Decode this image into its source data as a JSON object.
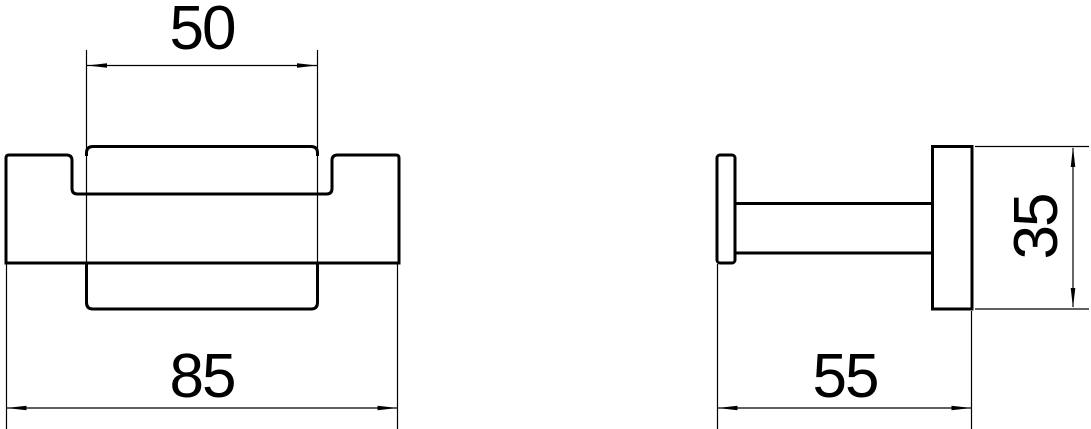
{
  "page": {
    "background_color": "#ffffff",
    "line_color": "#000000"
  },
  "drawing": {
    "type": "technical-dimension-drawing",
    "subject": "wall-hook-two-view-drawing",
    "views": [
      {
        "name": "front-view",
        "dimensions": [
          {
            "id": "plate-width",
            "label": "50",
            "orientation": "horizontal"
          },
          {
            "id": "overall-width",
            "label": "85",
            "orientation": "horizontal"
          }
        ]
      },
      {
        "name": "side-view",
        "dimensions": [
          {
            "id": "overall-depth",
            "label": "55",
            "orientation": "horizontal"
          },
          {
            "id": "plate-height",
            "label": "35",
            "orientation": "vertical"
          }
        ]
      }
    ]
  }
}
